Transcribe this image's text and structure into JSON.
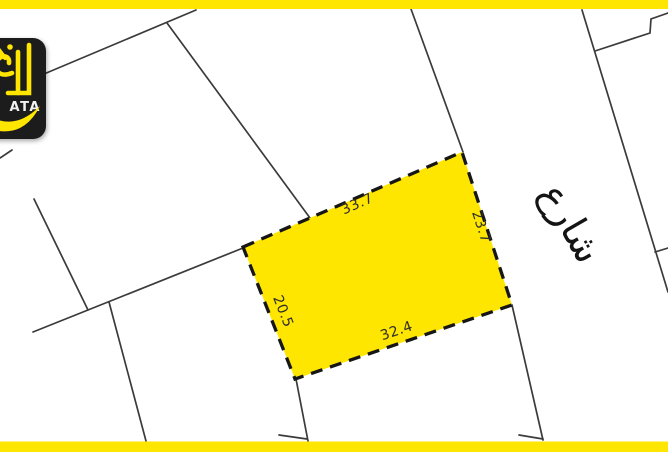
{
  "map": {
    "plot": {
      "dimensions": {
        "top": "33.7",
        "right": "23.7",
        "bottom": "32.4",
        "left": "20.5"
      }
    },
    "street": {
      "label": "شارع"
    }
  },
  "logo": {
    "text": "ATA"
  },
  "colors": {
    "accent_yellow": "#ffe600",
    "plot_fill": "#ffe600",
    "boundary_line": "#3b3b3b",
    "plot_border": "#161616",
    "dimension_text": "#2d2d2d",
    "street_text": "#141414",
    "logo_background": "#1b1b1f",
    "logo_accent": "#ffe600",
    "logo_text": "#f2f2f2",
    "page_background": "#ffffff"
  }
}
